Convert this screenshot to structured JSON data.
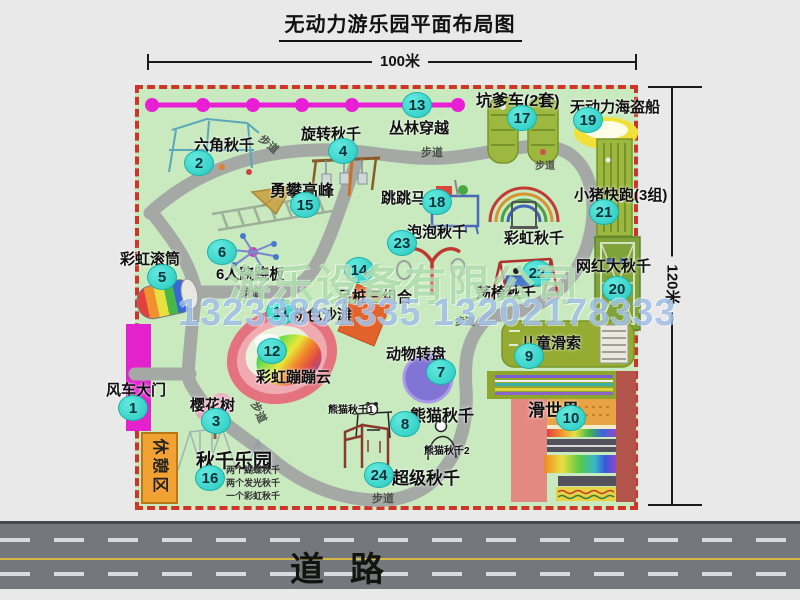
{
  "title": "无动力游乐园平面布局图",
  "dimensions": {
    "top": "100米",
    "right": "120米"
  },
  "road_label": "道路",
  "walkway_label": "步道",
  "rest_area_label": "休憩区",
  "watermark": {
    "company": "游乐设备有限公司",
    "phone": "13233861335 13202178333"
  },
  "attractions": [
    {
      "num": "1",
      "label": "风车大门"
    },
    {
      "num": "2",
      "label": "六角秋千"
    },
    {
      "num": "3",
      "label": "樱花树"
    },
    {
      "num": "4",
      "label": "旋转秋千"
    },
    {
      "num": "5",
      "label": "彩虹滚筒"
    },
    {
      "num": "6",
      "label": "6人跷跷板"
    },
    {
      "num": "7",
      "label": "动物转盘"
    },
    {
      "num": "8",
      "label": "熊猫秋千"
    },
    {
      "num": "9",
      "label": "儿童滑索"
    },
    {
      "num": "10",
      "label": "滑世界"
    },
    {
      "num": "11",
      "label": "粉色沙滩"
    },
    {
      "num": "12",
      "label": "彩虹蹦蹦云"
    },
    {
      "num": "13",
      "label": "丛林穿越"
    },
    {
      "num": "14",
      "label": "吊桩三组合"
    },
    {
      "num": "15",
      "label": "勇攀高峰"
    },
    {
      "num": "16",
      "label": "秋千乐园",
      "notes": [
        "两个蝴蝶秋千",
        "两个发光秋千",
        "一个彩虹秋千"
      ]
    },
    {
      "num": "17",
      "label": "坑爹车(2套)"
    },
    {
      "num": "18",
      "label": "跳跳马"
    },
    {
      "num": "19",
      "label": "无动力海盗船"
    },
    {
      "num": "20",
      "label": "网红大秋千"
    },
    {
      "num": "21",
      "label": "小猪快跑(3组)"
    },
    {
      "num": "22",
      "label": "荡椅秋千"
    },
    {
      "num": "23",
      "label": "泡泡秋千"
    },
    {
      "num": "24",
      "label": "超级秋千"
    }
  ],
  "extra_labels": {
    "rainbow_swing": "彩虹秋千",
    "panda_swing_1": "熊猫秋千1",
    "panda_swing_2": "熊猫秋千2"
  },
  "colors": {
    "map_green": "#c9e9bf",
    "border_red": "#d03428",
    "path_gray": "#a4a9a6",
    "badge_cyan": "#27c9c0",
    "gate_magenta": "#e321cd",
    "zipline_magenta": "#e81fd4",
    "rest_orange": "#f2a233",
    "road_gray": "#74787e",
    "road_yellow": "#d4b944"
  }
}
